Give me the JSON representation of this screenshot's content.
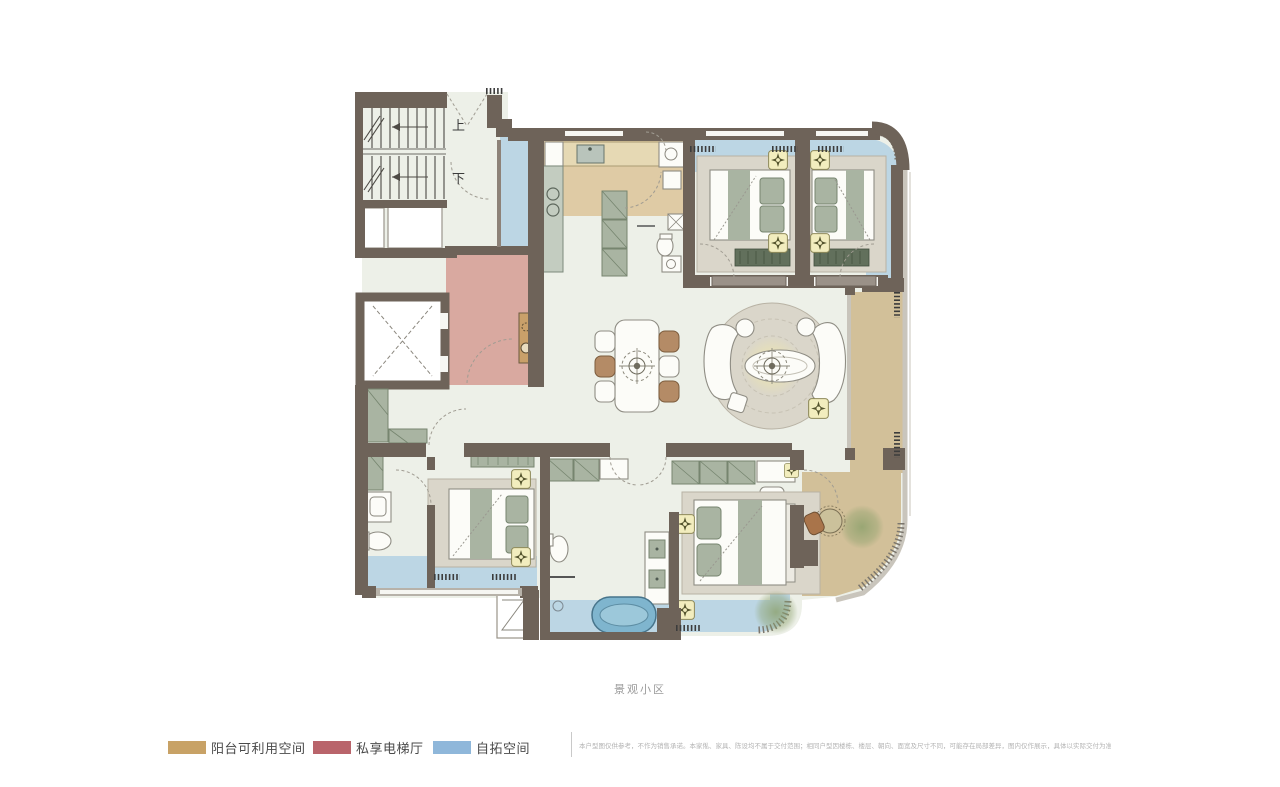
{
  "plan": {
    "caption": "景观小区",
    "stair_up_label": "上",
    "stair_down_label": "下"
  },
  "legend": {
    "items": [
      {
        "id": "balcony-usable-space",
        "label": "阳台可利用空间",
        "color": "#C8A266"
      },
      {
        "id": "private-elevator-hall",
        "label": "私享电梯厅",
        "color": "#B9646B"
      },
      {
        "id": "self-expansion-space",
        "label": "自拓空间",
        "color": "#8FB7DA"
      }
    ]
  },
  "disclaimer": "本户型图仅供参考，不作为销售承诺。本家俬、家具、陈设均不属于交付范围；相同户型因楼栋、楼层、朝向、面宽及尺寸不同，可能存在局部差异，图内仅作展示，具体以实际交付为准。",
  "colors": {
    "pageBg": "#ffffff",
    "wall": "#6E6359",
    "wallLight": "#8D8278",
    "floor": "#EDF0E8",
    "kitchenFloor": "#DFCBA5",
    "balcony": "#D2C099",
    "blueZone": "#BCD6E4",
    "pinkZone": "#D9A9A0",
    "cabinetGreen": "#A9B4A2",
    "cabinetGreenDark": "#76856F",
    "benchGreen": "#62705C",
    "rug": "#DAD6CA",
    "rugLine": "#B8B2A4",
    "bedWhite": "#FCFCF8",
    "lampYellow": "#F2EDBE",
    "tubBlue": "#7FB5CE",
    "tubBlueDark": "#47748B",
    "chairBrown": "#B48B66",
    "plantGreen": "#8BA06B",
    "captionGray": "#9B9B9B",
    "disclaimerGray": "#B3B3B3"
  }
}
